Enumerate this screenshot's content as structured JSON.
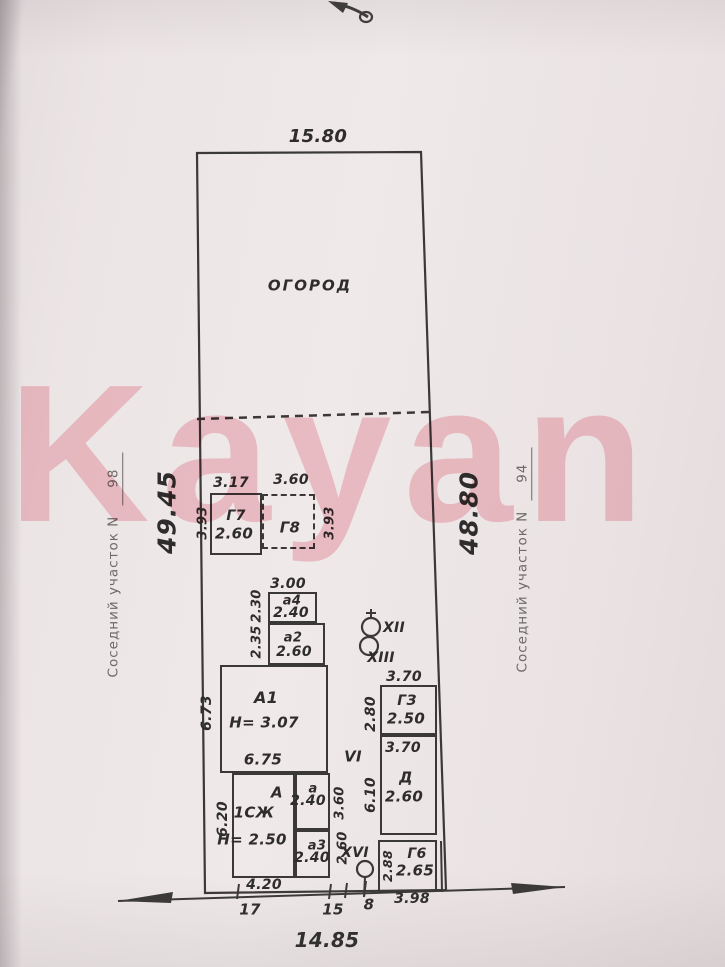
{
  "watermark": "Kayan",
  "plot": {
    "top_width": "15.80",
    "bottom_width": "14.85",
    "left_length": "49.45",
    "right_length": "48.80",
    "garden_label": "ОГОРОД",
    "left_neighbor": {
      "label": "Соседний участок N",
      "number": "98"
    },
    "right_neighbor": {
      "label": "Соседний участок N",
      "number": "94"
    }
  },
  "buildings": {
    "g7": {
      "name": "Г7",
      "value": "2.60",
      "dim_top": "3.17",
      "dim_side": "3.93"
    },
    "g8": {
      "name": "Г8",
      "dim_top": "3.60",
      "dim_side": "3.93"
    },
    "a4": {
      "name": "а4",
      "value": "2.40",
      "dim_top": "3.00",
      "dim_side": "2.30"
    },
    "a2": {
      "name": "а2",
      "value": "2.60",
      "dim_side": "2.35"
    },
    "A1": {
      "name": "А1",
      "height_note": "Н= 3.07",
      "dim_bottom": "6.75",
      "dim_side": "6.73"
    },
    "g3": {
      "name": "ГЗ",
      "value": "2.50",
      "dim_top": "3.70",
      "dim_side": "2.80"
    },
    "d": {
      "name": "Д",
      "value": "2.60",
      "dim_top": "3.70",
      "dim_side": "6.10"
    },
    "A": {
      "name": "А",
      "usage": "1СЖ",
      "height_note": "Н= 2.50",
      "dim_side": "6.20",
      "dim_bottom": "4.20"
    },
    "a": {
      "name": "а",
      "value": "2.40",
      "dim_side": "3.60"
    },
    "a3": {
      "name": "а3",
      "value": "2.40",
      "dim_side": "2.60"
    },
    "g6": {
      "name": "Г6",
      "value": "2.65",
      "dim_side": "2.88",
      "dim_bottom": "3.98"
    }
  },
  "marks": {
    "vi": "VI",
    "xii": "XII",
    "xiii": "XIII",
    "xvi": "XVI"
  },
  "bottom_segments": {
    "s17": "17",
    "s15": "15",
    "s8": "8"
  },
  "colors": {
    "ink": "#3b3838",
    "watermark_pink": "#f19daa",
    "paper": "#ece5e6"
  }
}
